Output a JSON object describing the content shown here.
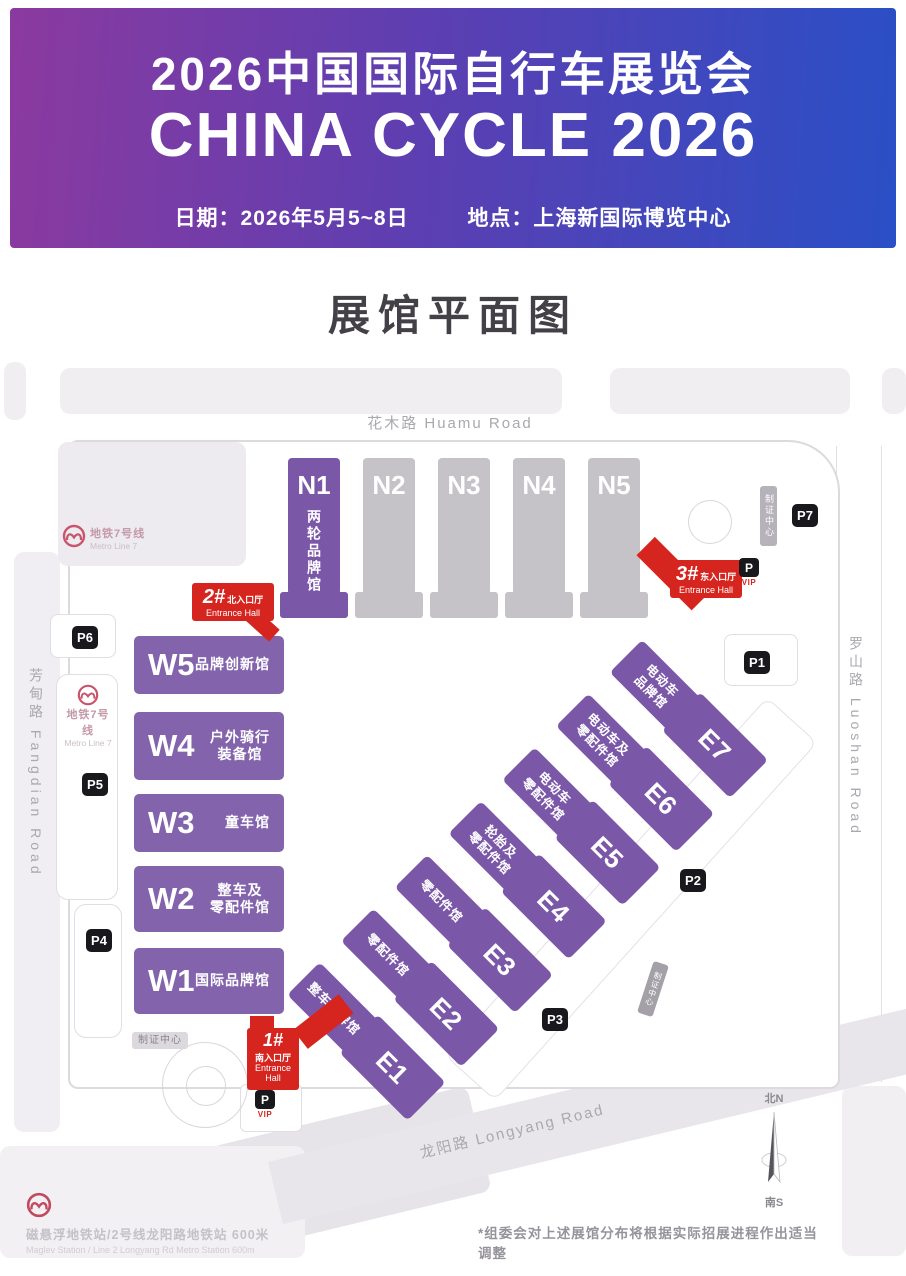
{
  "header": {
    "title_zh": "2026中国国际自行车展览会",
    "title_en": "CHINA CYCLE 2026",
    "date_label": "日期：2026年5月5~8日",
    "venue_label": "地点：上海新国际博览中心"
  },
  "map_title": "展馆平面图",
  "roads": {
    "huamu": "花木路  Huamu Road",
    "fangdian": "芳甸路 Fangdian Road",
    "luoshan": "罗山路 Luoshan Road",
    "longyang": "龙阳路  Longyang Road"
  },
  "metro": {
    "line7_zh": "地铁7号线",
    "line7_en": "Metro Line 7",
    "maglev_zh": "磁悬浮地铁站/2号线龙阳路地铁站  600米",
    "maglev_en": "Maglev Station / Line 2 Longyang Rd Metro Station 600m"
  },
  "labels": {
    "badge_center": "制证中心",
    "p": "P",
    "vip": "VIP"
  },
  "compass": {
    "north": "北N",
    "south": "南S"
  },
  "footnote": "*组委会对上述展馆分布将根据实际招展进程作出适当调整",
  "entrances": {
    "south": {
      "num": "1#",
      "name": "南入口厅",
      "en": "Entrance Hall"
    },
    "north": {
      "num": "2#",
      "name": "北入口厅",
      "en": "Entrance Hall"
    },
    "east": {
      "num": "3#",
      "name": "东入口厅",
      "en": "Entrance Hall"
    }
  },
  "parking": {
    "p1": "P1",
    "p2": "P2",
    "p3": "P3",
    "p4": "P4",
    "p5": "P5",
    "p6": "P6",
    "p7": "P7"
  },
  "halls": {
    "n": [
      {
        "code": "N1",
        "label": "两轮品牌馆"
      },
      {
        "code": "N2",
        "label": ""
      },
      {
        "code": "N3",
        "label": ""
      },
      {
        "code": "N4",
        "label": ""
      },
      {
        "code": "N5",
        "label": ""
      }
    ],
    "w": [
      {
        "code": "W5",
        "label": "品牌创新馆"
      },
      {
        "code": "W4",
        "label": "户外骑行\n装备馆"
      },
      {
        "code": "W3",
        "label": "童车馆"
      },
      {
        "code": "W2",
        "label": "整车及\n零配件馆"
      },
      {
        "code": "W1",
        "label": "国际品牌馆"
      }
    ],
    "e": [
      {
        "code": "E7",
        "label": "电动车\n品牌馆"
      },
      {
        "code": "E6",
        "label": "电动车及\n零配件馆"
      },
      {
        "code": "E5",
        "label": "电动车\n零配件馆"
      },
      {
        "code": "E4",
        "label": "轮胎及\n零配件馆"
      },
      {
        "code": "E3",
        "label": "零配件馆"
      },
      {
        "code": "E2",
        "label": "零配件馆"
      },
      {
        "code": "E1",
        "label": "整车品牌馆"
      }
    ]
  },
  "colors": {
    "hall_purple": "#7b57a8",
    "hall_gray": "#c6c3c8",
    "entrance_red": "#d6251f",
    "badge_black": "#19181c",
    "header_gradient_left": "#8b3a9f",
    "header_gradient_right": "#2a4fc6"
  }
}
